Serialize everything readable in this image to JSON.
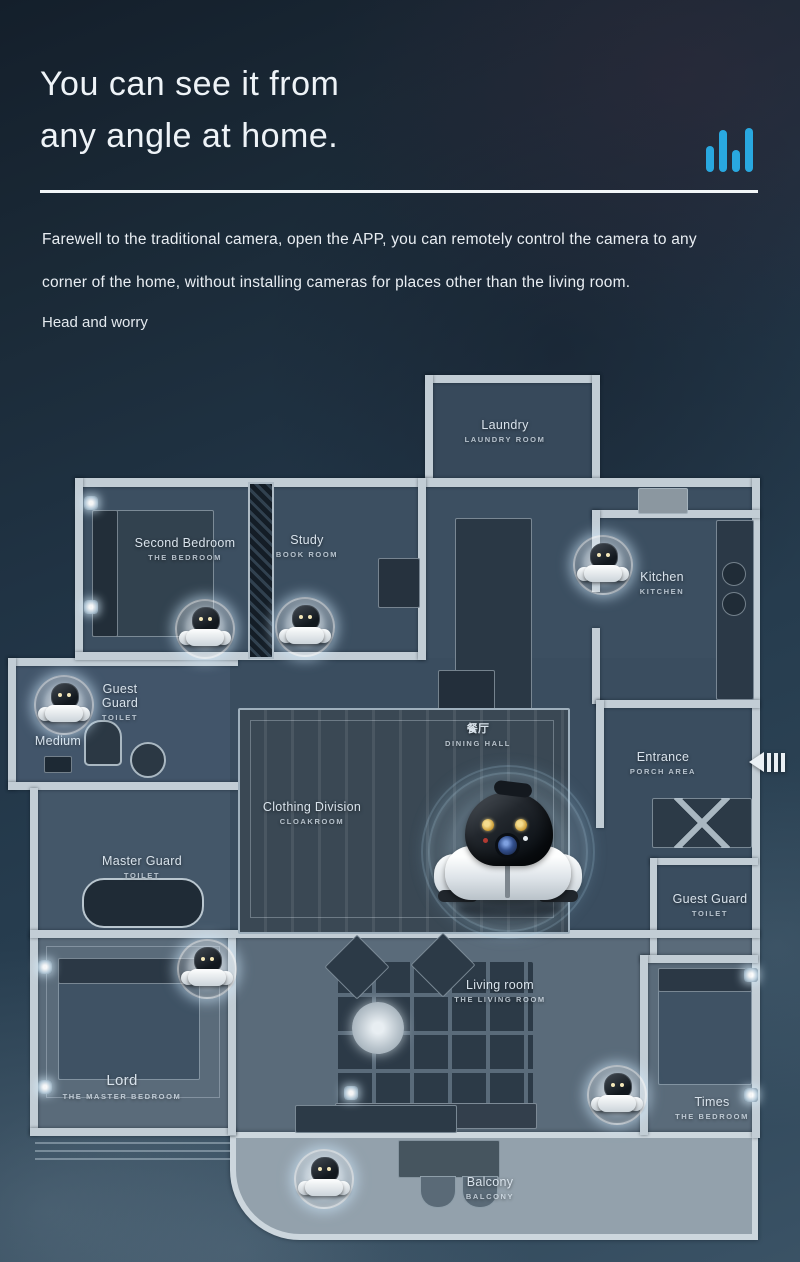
{
  "header": {
    "title_line1": "You can see it from",
    "title_line2": "any angle at home.",
    "body_line1": "Farewell to the traditional camera, open the APP, you can remotely control the camera to any",
    "body_line2": "corner of the home, without installing cameras for places other than the living room.",
    "note": "Head and worry"
  },
  "icons": {
    "top_right": "signal-bars-icon",
    "plan_right_edge": "collapse-left-icon"
  },
  "colors": {
    "accent_cyan": "#29A8E0",
    "background_dark": "#1C2C3A",
    "wall": "#C2CDD5",
    "floor_upper": "#3C4F61",
    "floor_lower": "#5A6B7A",
    "balcony_floor": "#93A1AC"
  },
  "floorplan": {
    "rooms": [
      {
        "label": "Laundry",
        "sublabel": "LAUNDRY ROOM"
      },
      {
        "label": "Second Bedroom",
        "sublabel": "THE BEDROOM"
      },
      {
        "label": "Study",
        "sublabel": "BOOK ROOM"
      },
      {
        "label": "Kitchen",
        "sublabel": "KITCHEN"
      },
      {
        "label": "Guest Guard",
        "sublabel": "TOILET"
      },
      {
        "label": "Medium",
        "sublabel": ""
      },
      {
        "label": "餐厅",
        "sublabel": "DINING HALL"
      },
      {
        "label": "Entrance",
        "sublabel": "PORCH AREA"
      },
      {
        "label": "Clothing Division",
        "sublabel": "CLOAKROOM"
      },
      {
        "label": "Master Guard",
        "sublabel": "TOILET"
      },
      {
        "label": "Guest Guard",
        "sublabel": "TOILET"
      },
      {
        "label": "Living room",
        "sublabel": "THE LIVING ROOM"
      },
      {
        "label": "Lord",
        "sublabel": "THE MASTER BEDROOM"
      },
      {
        "label": "Times",
        "sublabel": "THE BEDROOM"
      },
      {
        "label": "Balcony",
        "sublabel": "BALCONY"
      }
    ],
    "camera_markers": {
      "small_count": 7,
      "large_count": 1,
      "small_locations": [
        "kitchen",
        "second bedroom",
        "study",
        "guest toilet",
        "master bedroom",
        "times bedroom",
        "balcony"
      ],
      "large_location": "dining hall center"
    }
  }
}
